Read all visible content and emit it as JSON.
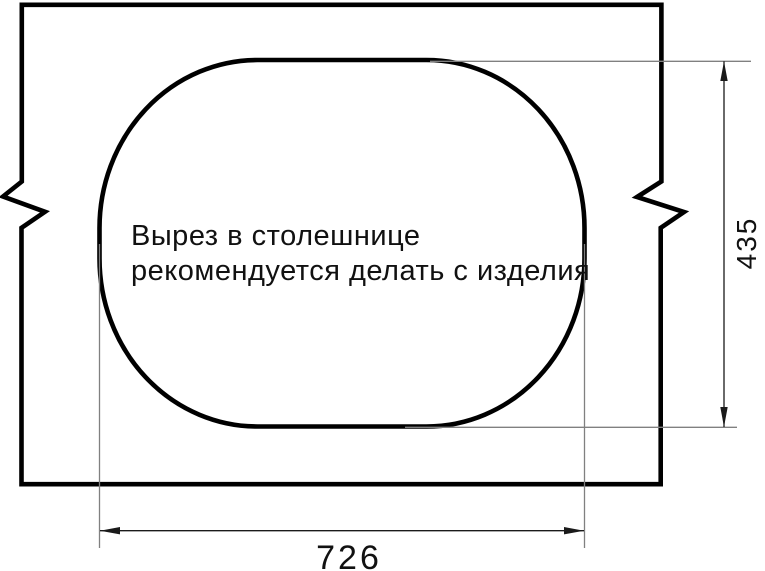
{
  "drawing": {
    "note": {
      "line1": "Вырез в столешнице",
      "line2": "рекомендуется делать с изделия"
    },
    "dimensions": {
      "width_label": "726",
      "height_label": "435"
    },
    "colors": {
      "outline": "#000000",
      "extension_line": "#808080",
      "dimension_line": "#1a1a1a",
      "text": "#111111",
      "background": "#ffffff"
    }
  }
}
